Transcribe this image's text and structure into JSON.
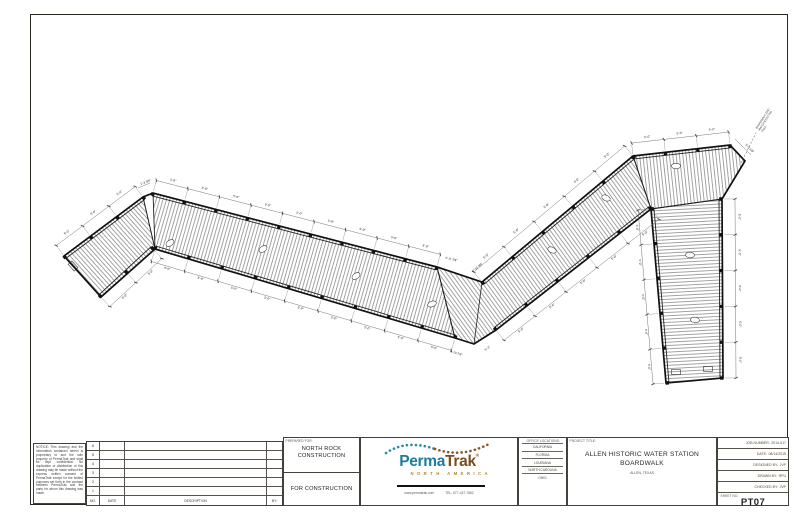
{
  "sheet": {
    "legal_note": "NOTICE: This drawing and the information contained herein is proprietary to and the sole property of PermaTrak and shall be kept confidential. No duplication or distribution of this drawing may be made without the express written consent of PermaTrak except for the limited purposes set forth in the contract between PermaTrak and the party for whom this drawing was made.",
    "revision_table": {
      "rows": [
        "6",
        "5",
        "4",
        "3",
        "2",
        "1"
      ],
      "headers": {
        "no": "NO.",
        "date": "DATE",
        "description": "DESCRIPTION",
        "by": "BY:"
      }
    },
    "prepared_for": {
      "label": "PREPARED FOR:",
      "client_line1": "NORTH ROCK",
      "client_line2": "CONSTRUCTION",
      "status": "FOR CONSTRUCTION"
    },
    "logo": {
      "brand_perma": "Perma",
      "brand_trak": "Trak",
      "registered": "®",
      "subtitle": "NORTH AMERICA",
      "website": "www.permatrak.com",
      "phone": "TEL: 877-437-7862",
      "teal": "#1c7d9e",
      "brown": "#7b4b1d",
      "gold": "#b08a2e"
    },
    "offices": {
      "label": "OFFICE LOCATIONS:",
      "items": [
        "CALIFORNIA",
        "FLORIDA",
        "LOUISIANA",
        "NORTH CAROLINA",
        "OHIO"
      ]
    },
    "project": {
      "label": "PROJECT TITLE:",
      "title_line1": "ALLEN HISTORIC WATER STATION",
      "title_line2": "BOARDWALK",
      "location": "ALLEN, TEXAS"
    },
    "info": {
      "job_number_label": "JOB NUMBER:",
      "job_number": "2014-017",
      "date_label": "DATE:",
      "date": "08/14/2015",
      "designed_label": "DESIGNED BY:",
      "designed": "JVP",
      "drawn_label": "DRAWN BY:",
      "drawn": "RPU",
      "checked_label": "CHECKED BY:",
      "checked": "JVP",
      "sheet_label": "SHEET NO.",
      "sheet_no": "PT07"
    }
  },
  "drawing": {
    "typical_dim": "5'-0\"",
    "special_dims": [
      "2'-3 3/8\"",
      "4'-11 7/8\"",
      "4'-10 3/8\"",
      "4'-10 7/8\"",
      "5'-3\"",
      "5'-0 1/8\""
    ],
    "end_note_lines": [
      "BOARDWALK END",
      "MATCH EXISTING",
      "TRAIL"
    ]
  }
}
